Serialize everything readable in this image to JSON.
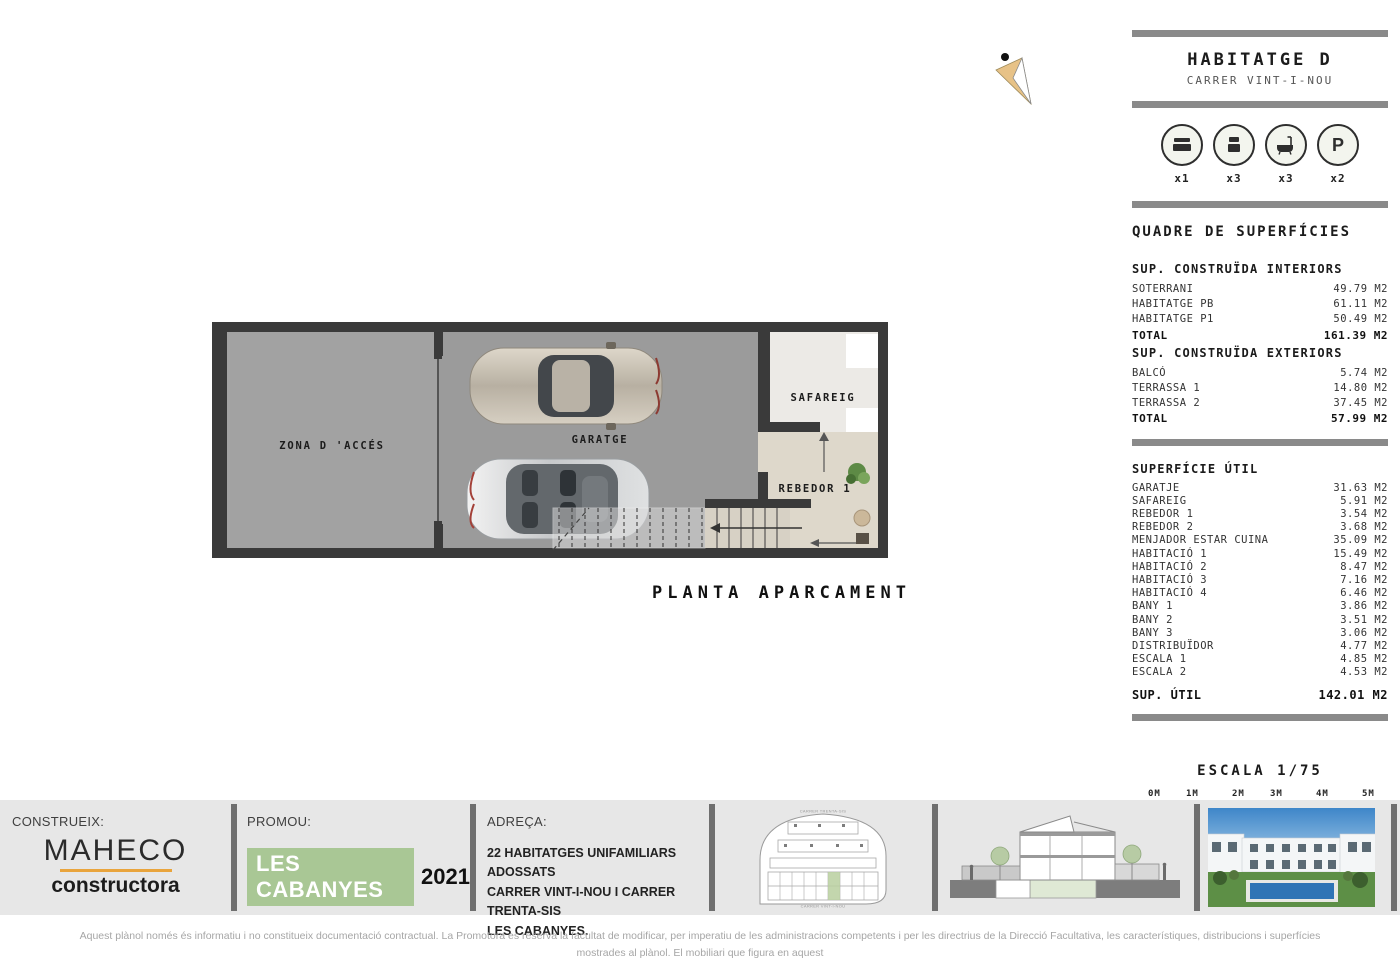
{
  "header": {
    "title": "HABITATGE D",
    "subtitle": "CARRER VINT-I-NOU",
    "features": [
      {
        "icon": "double-bed-icon",
        "count": "x1"
      },
      {
        "icon": "single-bed-icon",
        "count": "x3"
      },
      {
        "icon": "bathtub-icon",
        "count": "x3"
      },
      {
        "icon": "parking-icon",
        "count": "x2"
      }
    ],
    "parking_glyph": "P"
  },
  "surfaces": {
    "title": "QUADRE DE SUPERFÍCIES",
    "interiors": {
      "heading": "SUP. CONSTRUÏDA INTERIORS",
      "rows": [
        {
          "label": "SOTERRANI",
          "value": "49.79 M2"
        },
        {
          "label": "HABITATGE PB",
          "value": "61.11 M2"
        },
        {
          "label": "HABITATGE P1",
          "value": "50.49 M2"
        }
      ],
      "total_label": "TOTAL",
      "total_value": "161.39 M2"
    },
    "exteriors": {
      "heading": "SUP. CONSTRUÏDA EXTERIORS",
      "rows": [
        {
          "label": "BALCÓ",
          "value": "5.74 M2"
        },
        {
          "label": "TERRASSA 1",
          "value": "14.80 M2"
        },
        {
          "label": "TERRASSA 2",
          "value": "37.45 M2"
        }
      ],
      "total_label": "TOTAL",
      "total_value": "57.99 M2"
    },
    "util": {
      "heading": "SUPERFÍCIE ÚTIL",
      "rows": [
        {
          "label": "GARATJE",
          "value": "31.63 M2"
        },
        {
          "label": "SAFAREIG",
          "value": "5.91 M2"
        },
        {
          "label": "REBEDOR 1",
          "value": "3.54 M2"
        },
        {
          "label": "REBEDOR 2",
          "value": "3.68 M2"
        },
        {
          "label": "MENJADOR ESTAR CUINA",
          "value": "35.09 M2"
        },
        {
          "label": "HABITACIÓ 1",
          "value": "15.49 M2"
        },
        {
          "label": "HABITACIÓ 2",
          "value": "8.47 M2"
        },
        {
          "label": "HABITACIÓ 3",
          "value": "7.16 M2"
        },
        {
          "label": "HABITACIÓ 4",
          "value": "6.46 M2"
        },
        {
          "label": "BANY 1",
          "value": "3.86 M2"
        },
        {
          "label": "BANY 2",
          "value": "3.51 M2"
        },
        {
          "label": "BANY 3",
          "value": "3.06 M2"
        },
        {
          "label": "DISTRIBUÏDOR",
          "value": "4.77 M2"
        },
        {
          "label": "ESCALA 1",
          "value": "4.85 M2"
        },
        {
          "label": "ESCALA 2",
          "value": "4.53 M2"
        }
      ],
      "total_label": "SUP. ÚTIL",
      "total_value": "142.01 M2"
    }
  },
  "scalebar": {
    "label": "ESCALA 1/75",
    "ticks": [
      "0M",
      "1M",
      "2M",
      "3M",
      "4M",
      "5M"
    ]
  },
  "plan": {
    "title": "PLANTA APARCAMENT",
    "room_access": "ZONA D 'ACCÉS",
    "room_garage": "GARATGE",
    "room_laundry": "SAFAREIG",
    "room_hall": "REBEDOR 1"
  },
  "footer": {
    "construeix_label": "CONSTRUEIX:",
    "builder_name": "MAHECO",
    "builder_sub": "constructora",
    "promou_label": "PROMOU:",
    "promoter_name": "LES CABANYES",
    "promoter_year": "2021",
    "adreca_label": "ADREÇA:",
    "address_lines": [
      "22 HABITATGES UNIFAMILIARS ADOSSATS",
      "CARRER VINT-I-NOU I CARRER TRENTA-SIS",
      "LES CABANYES."
    ],
    "siteplan_top_label": "CARRER TRENTA-SIS",
    "siteplan_bottom_label": "CARRER VINT-I-NOU"
  },
  "disclaimer": {
    "line1": "Aquest plànol només és informatiu i no constitueix documentació contractual. La Promotora es reserva la facultat de modificar, per imperatiu de les administracions competents i per les directrius de la Direcció Facultativa, les característiques, distribucions i superfícies mostrades al plànol. El mobiliari que figura en aquest",
    "line2": "plànol és orientatiu i no forma part de l'habitatge. Prohibida qualsevol reproducció i/o modificació total o parcial sense autorització expressa de la Propietat."
  },
  "colors": {
    "wall": "#3a3a3a",
    "garage_floor": "#9b9b9b",
    "access_floor": "#a2a2a2",
    "laundry_floor": "#eceae6",
    "hall_floor": "#ded8cb",
    "bar_gray": "#8a8a8a",
    "accent_green": "#a9c795",
    "accent_orange": "#e9a43c",
    "footer_band": "#e7e7e7"
  }
}
